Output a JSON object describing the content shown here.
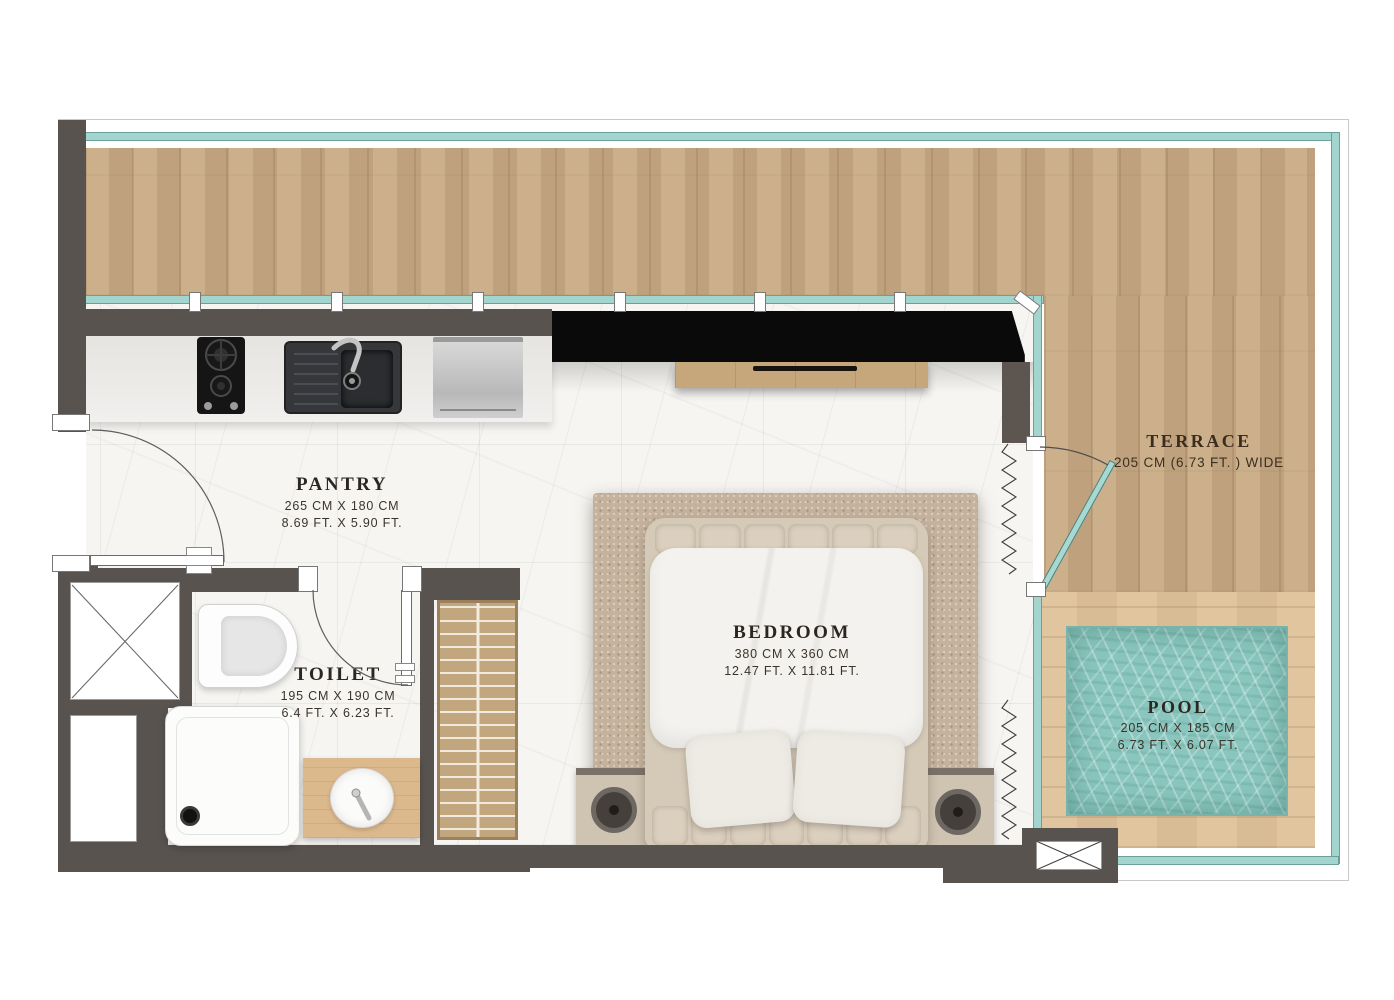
{
  "rooms": {
    "pantry": {
      "name": "PANTRY",
      "dim_cm": "265 CM X 180 CM",
      "dim_ft": "8.69 FT. X 5.90 FT."
    },
    "toilet": {
      "name": "TOILET",
      "dim_cm": "195 CM X 190 CM",
      "dim_ft": "6.4 FT. X 6.23 FT."
    },
    "bedroom": {
      "name": "BEDROOM",
      "dim_cm": "380 CM X 360 CM",
      "dim_ft": "12.47 FT. X 11.81 FT."
    },
    "terrace": {
      "name": "TERRACE",
      "dim": "205 CM (6.73 FT. ) WIDE"
    },
    "pool": {
      "name": "POOL",
      "dim_cm": "205 CM X 185 CM",
      "dim_ft": "6.73 FT. X 6.07 FT."
    }
  },
  "colors": {
    "wall_dark": "#59534f",
    "glass_teal": "#a3d5cf",
    "tv_wall_black": "#0a0a0a",
    "terrace_wood": "#c9ab84",
    "deck_wood": "#dec29a",
    "pool_water": "#8ac6be",
    "marble_floor": "#f6f5f2",
    "rug": "#c4b29c"
  }
}
